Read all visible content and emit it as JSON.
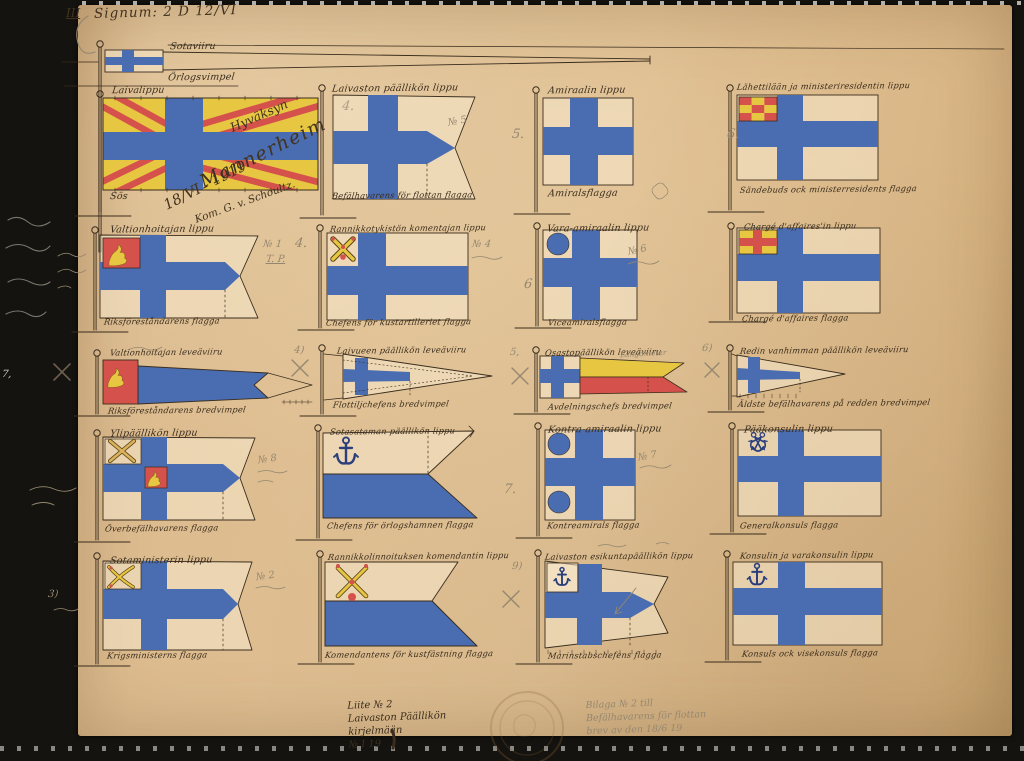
{
  "header": {
    "numeral": "III",
    "signum": "Signum: 2 D 12/VI"
  },
  "approval": {
    "approve": "Hyväksyn",
    "signature": "Mannerheim",
    "date": "18/VI - 1919",
    "countersign": "Kom. G. v. Schoultz."
  },
  "top_pennant": {
    "fi": "Sotaviiru",
    "sv": "Örlogsvimpel"
  },
  "flags": [
    {
      "fi": "Laivalippu",
      "sv": "Sös"
    },
    {
      "fi": "Laivaston päällikön lippu",
      "sv": "Befälhavarens för flottan flagga"
    },
    {
      "fi": "Amiraalin lippu",
      "sv": "Amiralsflagga"
    },
    {
      "fi": "Lähettilään ja ministeriresidentin lippu",
      "sv": "Sändebuds ock ministerresidents flagga"
    },
    {
      "fi": "Valtionhoitajan lippu",
      "sv": "Riksföreståndarens flagga"
    },
    {
      "fi": "Rannikkotykistön komentajan lippu",
      "sv": "Chefens för kustartilleriet flagga"
    },
    {
      "fi": "Vara-amiraalin lippu",
      "sv": "Viceamiralsflagga"
    },
    {
      "fi": "Chargé d'affaires'in lippu",
      "sv": "Chargé d'affaires flagga"
    },
    {
      "fi": "Valtionhoitajan leveäviiru",
      "sv": "Riksföreståndarens bredvimpel"
    },
    {
      "fi": "Laivueen päällikön leveäviiru",
      "sv": "Flottiljchefens bredvimpel"
    },
    {
      "fi": "Osastopäällikön leveäviiru",
      "sv": "Avdelningschefs bredvimpel"
    },
    {
      "fi": "Redin vanhimman päällikön leveäviiru",
      "sv": "Äldste befälhavarens på redden bredvimpel"
    },
    {
      "fi": "Ylipäällikön lippu",
      "sv": "Överbefälhavarens flagga"
    },
    {
      "fi": "Sotasataman päällikön lippu",
      "sv": "Chefens för örlogshamnen flagga"
    },
    {
      "fi": "Kontra-amiraalin lippu",
      "sv": "Kontreamirals flagga"
    },
    {
      "fi": "Pääkonsulin lippu",
      "sv": "Generalkonsuls flagga"
    },
    {
      "fi": "Sotaministerin lippu",
      "sv": "Krigsministerns flagga"
    },
    {
      "fi": "Rannikkolinnoituksen komendantin lippu",
      "sv": "Komendantens för kustfästning flagga"
    },
    {
      "fi": "Laivaston esikuntapäällikön lippu",
      "sv": "Marinstabschefens flagga"
    },
    {
      "fi": "Konsulin ja varakonsulin lippu",
      "sv": "Konsuls ock visekonsuls flagga"
    }
  ],
  "pencil": {
    "n1": "№ 1",
    "tp": "T. P.",
    "c4a": "4.",
    "c4b": "4.",
    "n5": "№ 5",
    "c5": "5.",
    "c6": "6.",
    "n4": "№ 4",
    "c6b": "6",
    "n6": "№ 6",
    "n7": "№ 7",
    "c7": "7.",
    "n8": "№ 8",
    "n2": "№ 2",
    "c9": "9)",
    "c3": "3)",
    "c5p": "5,",
    "c6p": "6)",
    "c4p": "4)",
    "white7": "7,",
    "langd": "Längdmeter"
  },
  "notes": {
    "ink_lines": [
      "Liite № 2",
      "Laivaston Päällikön",
      "kirjelmään",
      "№ I 19"
    ],
    "pencil_lines": [
      "Bilaga № 2 till",
      "Befälhavarens för flottan",
      "brev av den 18/6 19"
    ]
  },
  "colors": {
    "paper": "#d9b88c",
    "field": "rgba(247,234,206,0.55)",
    "blue": "#4a6cb0",
    "navy": "#2c3f7d",
    "yellow": "#e7c642",
    "red": "#d5524c",
    "ink": "#3a2d1d",
    "pencil": "#95876f"
  }
}
